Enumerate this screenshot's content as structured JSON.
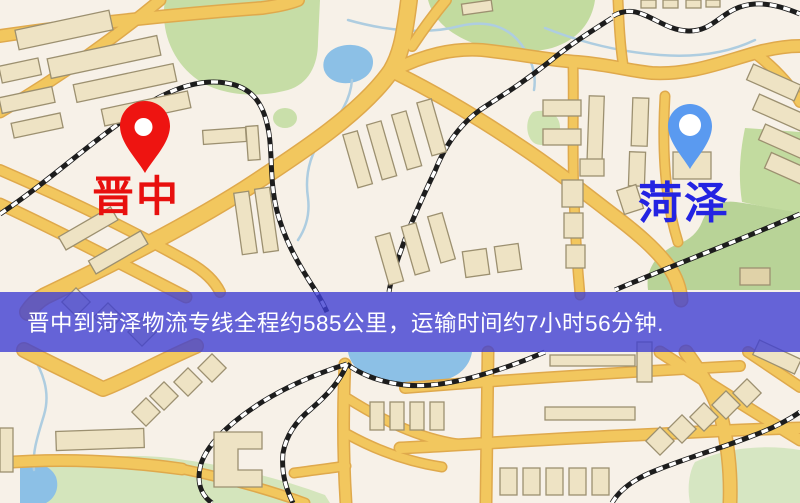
{
  "map": {
    "markers": {
      "origin": {
        "label": "晋中",
        "pin_color": "#ee1411",
        "label_color": "#e8100e"
      },
      "destination": {
        "label": "菏泽",
        "pin_color": "#5a9af0",
        "label_color": "#2323e2"
      }
    },
    "banner": {
      "text": "晋中到菏泽物流专线全程约585公里，运输时间约7小时56分钟.",
      "background_color": "#4040d2",
      "text_color": "#ffffff"
    },
    "palette": {
      "background": "#f7f1e8",
      "road": "#f2c75e",
      "road_casing": "#dfa94c",
      "park": "#c6dda6",
      "water": "#8cc0e6",
      "building": "#eee3c4",
      "railway": "#1d1d1d"
    }
  }
}
